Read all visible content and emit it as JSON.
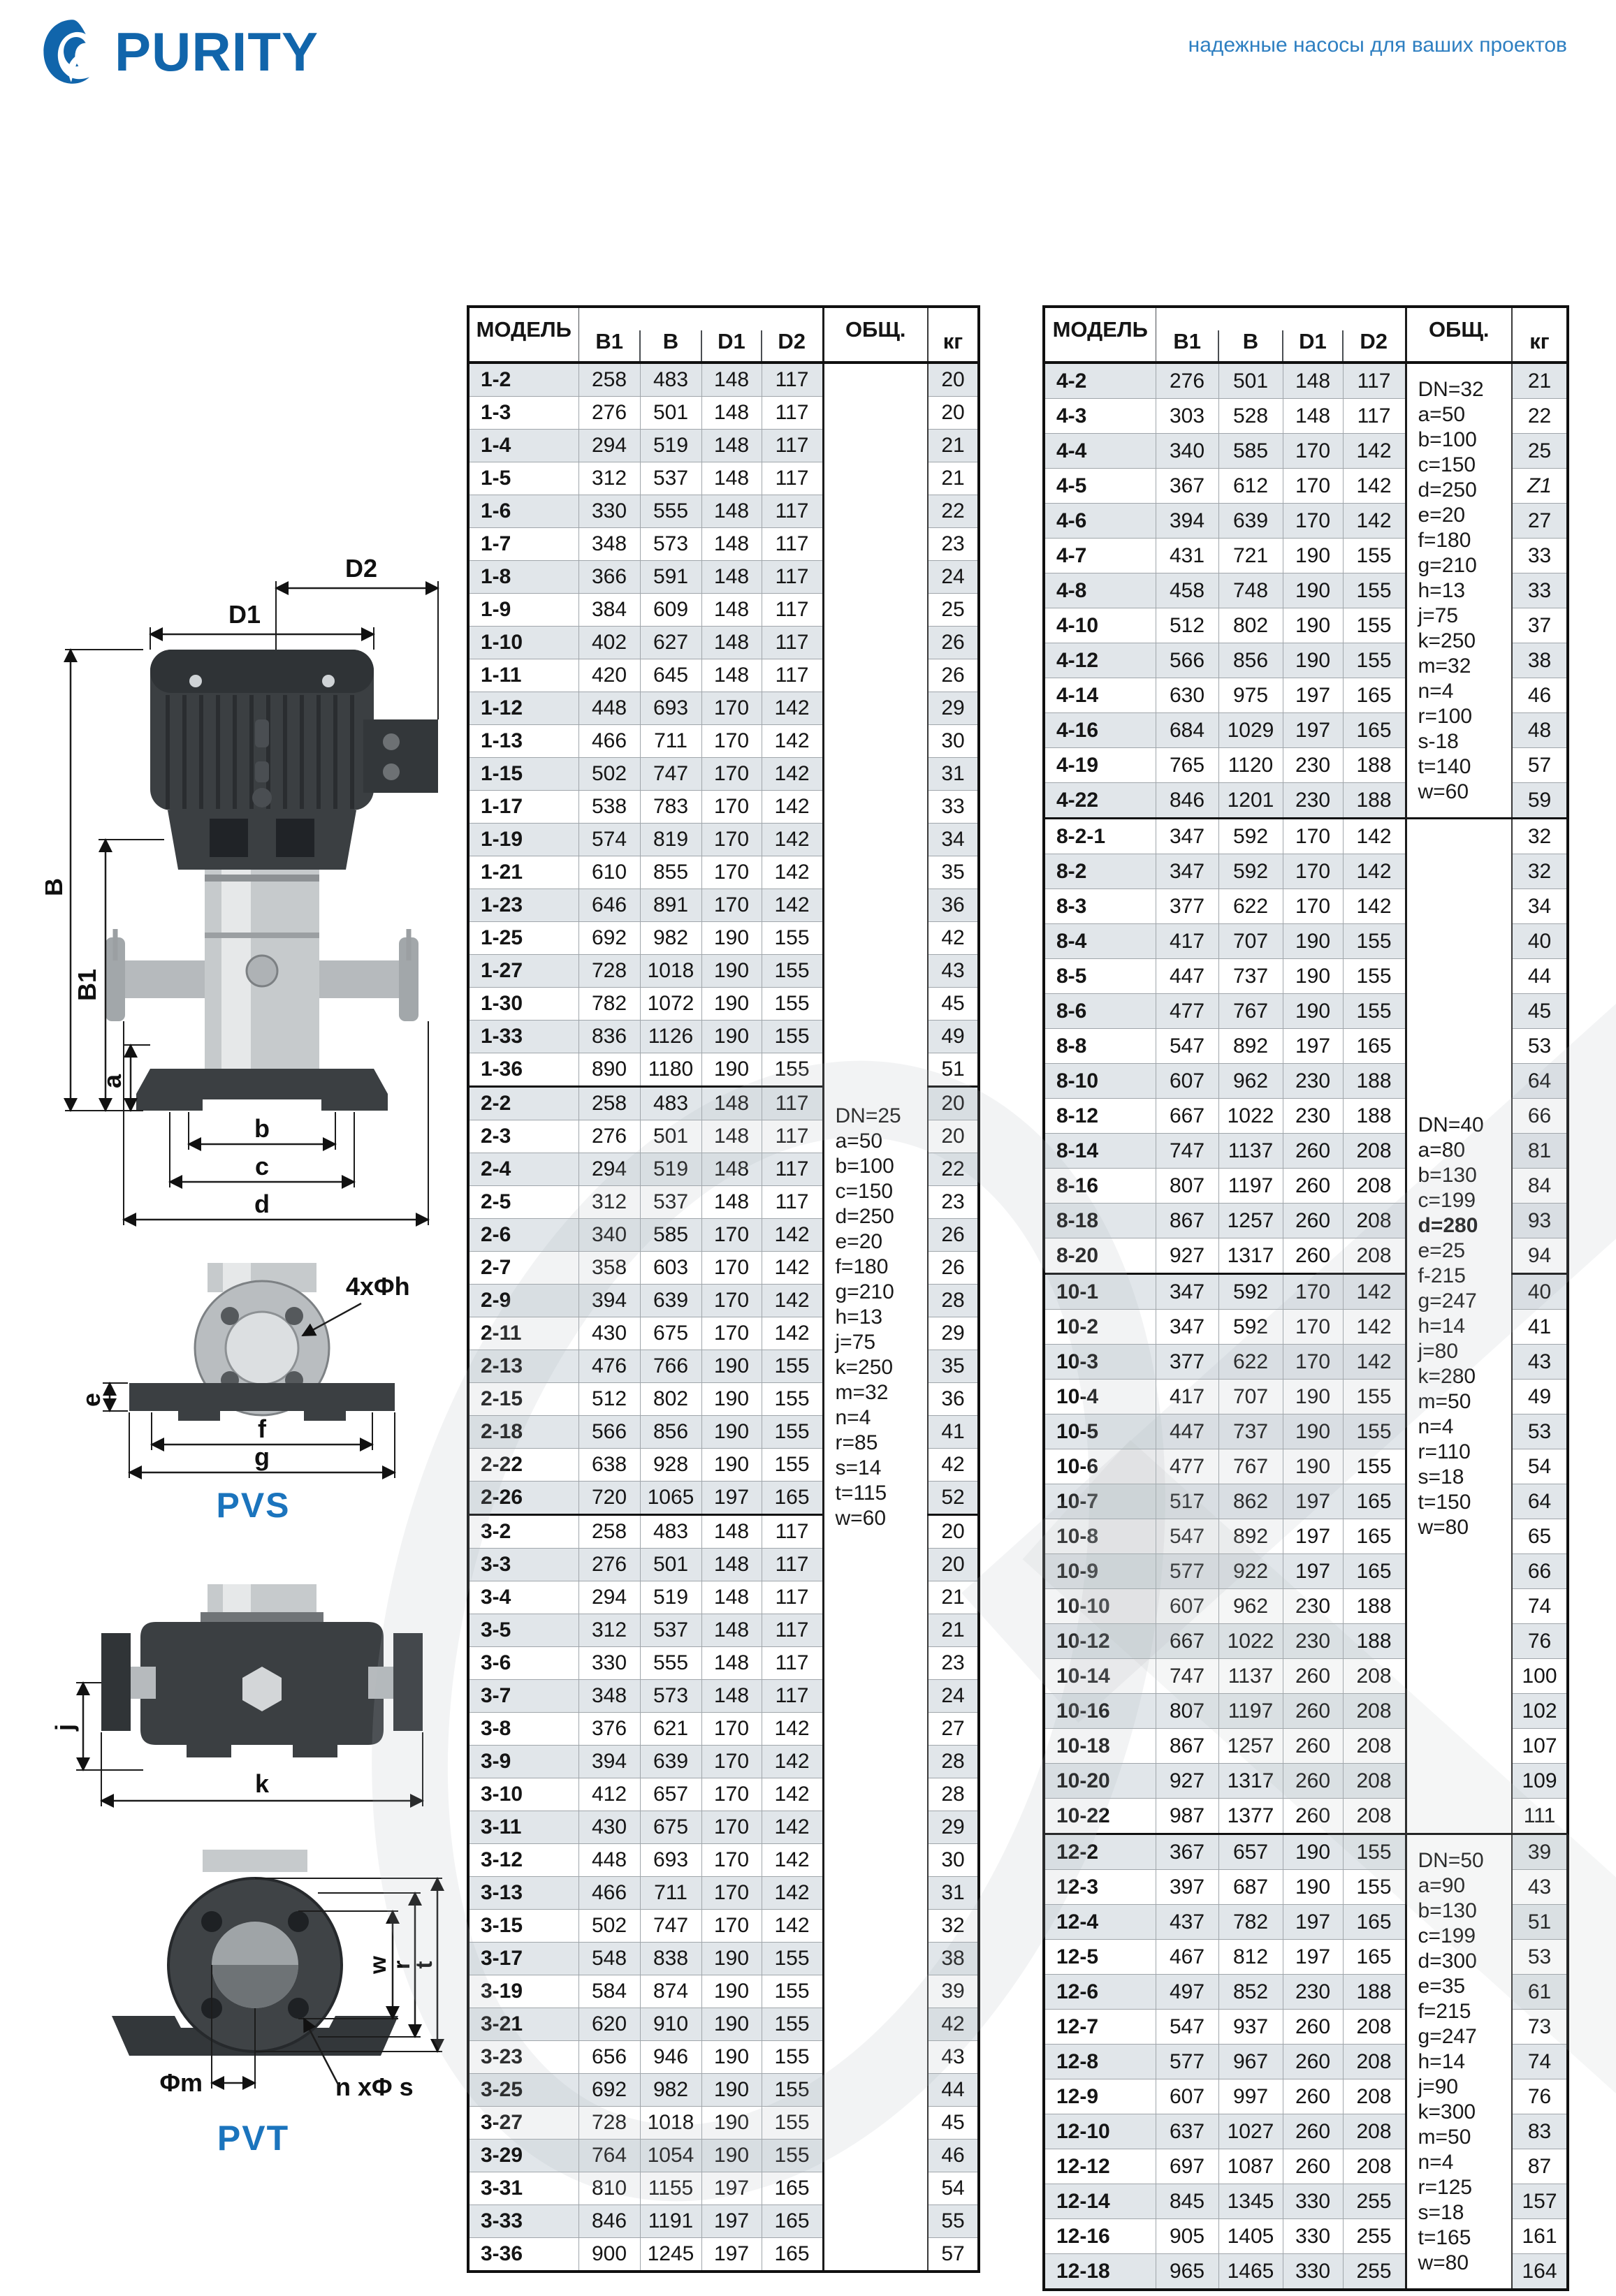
{
  "brand": {
    "name": "PURITY",
    "tagline": "надежные насосы для ваших проектов",
    "accent_color": "#1165ab",
    "tagline_color": "#2e7fc1"
  },
  "diagrams": {
    "pvs_label": "PVS",
    "pvt_label": "PVT",
    "dims": {
      "d1": "D1",
      "d2": "D2",
      "bu": "B",
      "b1": "B1",
      "a": "a",
      "b": "b",
      "c": "c",
      "d": "d",
      "e": "e",
      "f": "f",
      "g": "g",
      "holes": "4xΦh",
      "j": "j",
      "k": "k",
      "w": "w",
      "r": "r",
      "t": "t",
      "phim": "Φm",
      "nphis": "n xΦ s"
    }
  },
  "table": {
    "headers": {
      "model": "МОДЕЛЬ",
      "b1": "B1",
      "b": "B",
      "d1": "D1",
      "d2": "D2",
      "obsh": "ОБЩ.",
      "kg": "кг"
    },
    "shade_color": "#e1e6ea"
  },
  "left_table": {
    "sections": [
      {
        "note_lines": [
          "DN=25",
          "a=50",
          "b=100",
          "c=150",
          "d=250",
          "e=20",
          "f=180",
          "g=210",
          "h=13",
          "j=75",
          "k=250",
          "m=32",
          "n=4",
          "r=85",
          "s=14",
          "t=115",
          "w=60"
        ],
        "note_span": 3,
        "rows": [
          [
            "1-2",
            258,
            483,
            148,
            117,
            20
          ],
          [
            "1-3",
            276,
            501,
            148,
            117,
            20
          ],
          [
            "1-4",
            294,
            519,
            148,
            117,
            21
          ],
          [
            "1-5",
            312,
            537,
            148,
            117,
            21
          ],
          [
            "1-6",
            330,
            555,
            148,
            117,
            22
          ],
          [
            "1-7",
            348,
            573,
            148,
            117,
            23
          ],
          [
            "1-8",
            366,
            591,
            148,
            117,
            24
          ],
          [
            "1-9",
            384,
            609,
            148,
            117,
            25
          ],
          [
            "1-10",
            402,
            627,
            148,
            117,
            26
          ],
          [
            "1-11",
            420,
            645,
            148,
            117,
            26
          ],
          [
            "1-12",
            448,
            693,
            170,
            142,
            29
          ],
          [
            "1-13",
            466,
            711,
            170,
            142,
            30
          ],
          [
            "1-15",
            502,
            747,
            170,
            142,
            31
          ],
          [
            "1-17",
            538,
            783,
            170,
            142,
            33
          ],
          [
            "1-19",
            574,
            819,
            170,
            142,
            34
          ],
          [
            "1-21",
            610,
            855,
            170,
            142,
            35
          ],
          [
            "1-23",
            646,
            891,
            170,
            142,
            36
          ],
          [
            "1-25",
            692,
            982,
            190,
            155,
            42
          ],
          [
            "1-27",
            728,
            1018,
            190,
            155,
            43
          ],
          [
            "1-30",
            782,
            1072,
            190,
            155,
            45
          ],
          [
            "1-33",
            836,
            1126,
            190,
            155,
            49
          ],
          [
            "1-36",
            890,
            1180,
            190,
            155,
            51
          ]
        ]
      },
      {
        "rows": [
          [
            "2-2",
            258,
            483,
            148,
            117,
            20
          ],
          [
            "2-3",
            276,
            501,
            148,
            117,
            20
          ],
          [
            "2-4",
            294,
            519,
            148,
            117,
            22
          ],
          [
            "2-5",
            312,
            537,
            148,
            117,
            23
          ],
          [
            "2-6",
            340,
            585,
            170,
            142,
            26
          ],
          [
            "2-7",
            358,
            603,
            170,
            142,
            26
          ],
          [
            "2-9",
            394,
            639,
            170,
            142,
            28
          ],
          [
            "2-11",
            430,
            675,
            170,
            142,
            29
          ],
          [
            "2-13",
            476,
            766,
            190,
            155,
            35
          ],
          [
            "2-15",
            512,
            802,
            190,
            155,
            36
          ],
          [
            "2-18",
            566,
            856,
            190,
            155,
            41
          ],
          [
            "2-22",
            638,
            928,
            190,
            155,
            42
          ],
          [
            "2-26",
            720,
            1065,
            197,
            165,
            52
          ]
        ]
      },
      {
        "rows": [
          [
            "3-2",
            258,
            483,
            148,
            117,
            20
          ],
          [
            "3-3",
            276,
            501,
            148,
            117,
            20
          ],
          [
            "3-4",
            294,
            519,
            148,
            117,
            21
          ],
          [
            "3-5",
            312,
            537,
            148,
            117,
            21
          ],
          [
            "3-6",
            330,
            555,
            148,
            117,
            23
          ],
          [
            "3-7",
            348,
            573,
            148,
            117,
            24
          ],
          [
            "3-8",
            376,
            621,
            170,
            142,
            27
          ],
          [
            "3-9",
            394,
            639,
            170,
            142,
            28
          ],
          [
            "3-10",
            412,
            657,
            170,
            142,
            28
          ],
          [
            "3-11",
            430,
            675,
            170,
            142,
            29
          ],
          [
            "3-12",
            448,
            693,
            170,
            142,
            30
          ],
          [
            "3-13",
            466,
            711,
            170,
            142,
            31
          ],
          [
            "3-15",
            502,
            747,
            170,
            142,
            32
          ],
          [
            "3-17",
            548,
            838,
            190,
            155,
            38
          ],
          [
            "3-19",
            584,
            874,
            190,
            155,
            39
          ],
          [
            "3-21",
            620,
            910,
            190,
            155,
            42
          ],
          [
            "3-23",
            656,
            946,
            190,
            155,
            43
          ],
          [
            "3-25",
            692,
            982,
            190,
            155,
            44
          ],
          [
            "3-27",
            728,
            1018,
            190,
            155,
            45
          ],
          [
            "3-29",
            764,
            1054,
            190,
            155,
            46
          ],
          [
            "3-31",
            810,
            1155,
            197,
            165,
            54
          ],
          [
            "3-33",
            846,
            1191,
            197,
            165,
            55
          ],
          [
            "3-36",
            900,
            1245,
            197,
            165,
            57
          ]
        ]
      }
    ]
  },
  "right_table": {
    "sections": [
      {
        "note_lines": [
          "DN=32",
          "a=50",
          "b=100",
          "c=150",
          "d=250",
          "e=20",
          "f=180",
          "g=210",
          "h=13",
          "j=75",
          "k=250",
          "m=32",
          "n=4",
          "r=100",
          "s-18",
          "t=140",
          "w=60"
        ],
        "note_span": 1,
        "rows": [
          [
            "4-2",
            276,
            501,
            148,
            117,
            "21"
          ],
          [
            "4-3",
            303,
            528,
            148,
            117,
            "22"
          ],
          [
            "4-4",
            340,
            585,
            170,
            142,
            "25"
          ],
          [
            "4-5",
            367,
            612,
            170,
            142,
            "Z1"
          ],
          [
            "4-6",
            394,
            639,
            170,
            142,
            "27"
          ],
          [
            "4-7",
            431,
            721,
            190,
            155,
            "33"
          ],
          [
            "4-8",
            458,
            748,
            190,
            155,
            "33"
          ],
          [
            "4-10",
            512,
            802,
            190,
            155,
            "37"
          ],
          [
            "4-12",
            566,
            856,
            190,
            155,
            "38"
          ],
          [
            "4-14",
            630,
            975,
            197,
            165,
            "46"
          ],
          [
            "4-16",
            684,
            1029,
            197,
            165,
            "48"
          ],
          [
            "4-19",
            765,
            1120,
            230,
            188,
            "57"
          ],
          [
            "4-22",
            846,
            1201,
            230,
            188,
            "59"
          ]
        ]
      },
      {
        "note_lines": [
          "DN=40",
          "a=80",
          "b=130",
          "c=199",
          "d=280",
          "e=25",
          "f-215",
          "g=247",
          "h=14",
          "j=80",
          "k=280",
          "m=50",
          "n=4",
          "r=110",
          "s=18",
          "t=150",
          "w=80"
        ],
        "note_span": 2,
        "note_bold_index": 4,
        "rows": [
          [
            "8-2-1",
            347,
            592,
            170,
            142,
            32
          ],
          [
            "8-2",
            347,
            592,
            170,
            142,
            32
          ],
          [
            "8-3",
            377,
            622,
            170,
            142,
            34
          ],
          [
            "8-4",
            417,
            707,
            190,
            155,
            40
          ],
          [
            "8-5",
            447,
            737,
            190,
            155,
            44
          ],
          [
            "8-6",
            477,
            767,
            190,
            155,
            45
          ],
          [
            "8-8",
            547,
            892,
            197,
            165,
            53
          ],
          [
            "8-10",
            607,
            962,
            230,
            188,
            64
          ],
          [
            "8-12",
            667,
            1022,
            230,
            188,
            66
          ],
          [
            "8-14",
            747,
            1137,
            260,
            208,
            81
          ],
          [
            "8-16",
            807,
            1197,
            260,
            208,
            84
          ],
          [
            "8-18",
            867,
            1257,
            260,
            208,
            93
          ],
          [
            "8-20",
            927,
            1317,
            260,
            208,
            94
          ]
        ]
      },
      {
        "rows": [
          [
            "10-1",
            347,
            592,
            170,
            142,
            40
          ],
          [
            "10-2",
            347,
            592,
            170,
            142,
            41
          ],
          [
            "10-3",
            377,
            622,
            170,
            142,
            43
          ],
          [
            "10-4",
            417,
            707,
            190,
            155,
            49
          ],
          [
            "10-5",
            447,
            737,
            190,
            155,
            53
          ],
          [
            "10-6",
            477,
            767,
            190,
            155,
            54
          ],
          [
            "10-7",
            517,
            862,
            197,
            165,
            64
          ],
          [
            "10-8",
            547,
            892,
            197,
            165,
            65
          ],
          [
            "10-9",
            577,
            922,
            197,
            165,
            66
          ],
          [
            "10-10",
            607,
            962,
            230,
            188,
            74
          ],
          [
            "10-12",
            667,
            1022,
            230,
            188,
            76
          ],
          [
            "10-14",
            747,
            1137,
            260,
            208,
            100
          ],
          [
            "10-16",
            807,
            1197,
            260,
            208,
            102
          ],
          [
            "10-18",
            867,
            1257,
            260,
            208,
            107
          ],
          [
            "10-20",
            927,
            1317,
            260,
            208,
            109
          ],
          [
            "10-22",
            987,
            1377,
            260,
            208,
            111
          ]
        ]
      },
      {
        "note_lines": [
          "DN=50",
          "a=90",
          "b=130",
          "c=199",
          "d=300",
          "e=35",
          "f=215",
          "g=247",
          "h=14",
          "j=90",
          "k=300",
          "m=50",
          "n=4",
          "r=125",
          "s=18",
          "t=165",
          "w=80"
        ],
        "note_span": 1,
        "rows": [
          [
            "12-2",
            367,
            657,
            190,
            155,
            39
          ],
          [
            "12-3",
            397,
            687,
            190,
            155,
            43
          ],
          [
            "12-4",
            437,
            782,
            197,
            165,
            51
          ],
          [
            "12-5",
            467,
            812,
            197,
            165,
            53
          ],
          [
            "12-6",
            497,
            852,
            230,
            188,
            61
          ],
          [
            "12-7",
            547,
            937,
            260,
            208,
            73
          ],
          [
            "12-8",
            577,
            967,
            260,
            208,
            74
          ],
          [
            "12-9",
            607,
            997,
            260,
            208,
            76
          ],
          [
            "12-10",
            637,
            1027,
            260,
            208,
            83
          ],
          [
            "12-12",
            697,
            1087,
            260,
            208,
            87
          ],
          [
            "12-14",
            845,
            1345,
            330,
            255,
            157
          ],
          [
            "12-16",
            905,
            1405,
            330,
            255,
            161
          ],
          [
            "12-18",
            965,
            1465,
            330,
            255,
            164
          ]
        ]
      }
    ]
  }
}
